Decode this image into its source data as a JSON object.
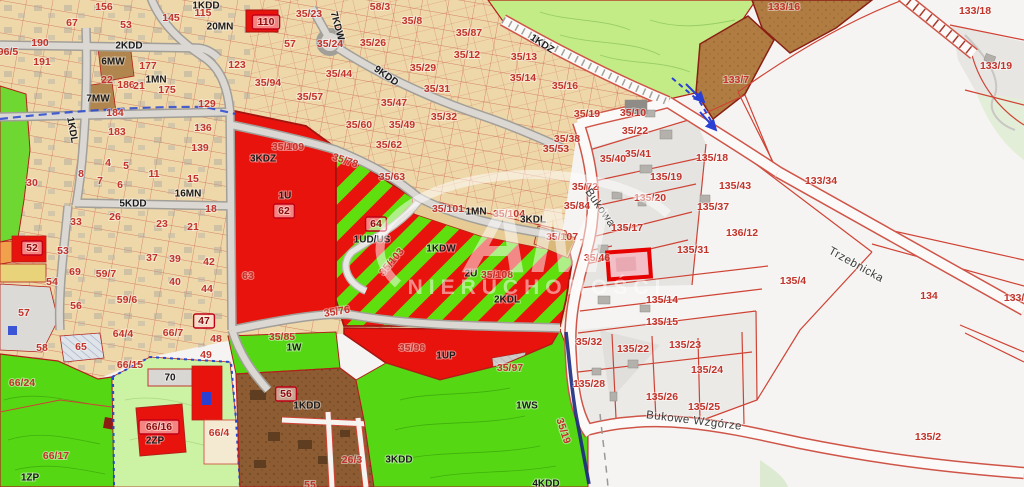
{
  "map": {
    "watermark": {
      "brand": "AM",
      "subtitle": "NIERUCHOMOŚCI"
    },
    "colors": {
      "urban_tan": "#eed8a9",
      "forest_green": "#c3ec86",
      "bright_green": "#55d714",
      "park_green": "#ccf2a4",
      "zone_red": "#e8130c",
      "stripe_green": "#5fdf0e",
      "brown_mw": "#b17c41",
      "brown_w": "#8d5c33",
      "gray_parcels": "#e5e4e1",
      "road_white": "#fbfaf8",
      "parcel_line_red": "#cf4335",
      "highlight_red": "#e60000",
      "stream_navy": "#1b2a7e",
      "utility_blue": "#2848d0"
    },
    "labels": [
      {
        "t": "156",
        "x": 104,
        "y": 7
      },
      {
        "t": "1KDD",
        "x": 206,
        "y": 6,
        "c": "d",
        "s": 8
      },
      {
        "t": "115",
        "x": 203,
        "y": 13
      },
      {
        "t": "67",
        "x": 72,
        "y": 23
      },
      {
        "t": "53",
        "x": 126,
        "y": 25
      },
      {
        "t": "145",
        "x": 171,
        "y": 18
      },
      {
        "t": "20MN",
        "x": 220,
        "y": 27,
        "c": "d",
        "s": 9
      },
      {
        "t": "190",
        "x": 40,
        "y": 43
      },
      {
        "t": "96/5",
        "x": 8,
        "y": 52
      },
      {
        "t": "2KDD",
        "x": 129,
        "y": 46,
        "c": "d",
        "s": 8
      },
      {
        "t": "191",
        "x": 42,
        "y": 62
      },
      {
        "t": "6MW",
        "x": 113,
        "y": 62,
        "c": "d",
        "s": 9
      },
      {
        "t": "177",
        "x": 148,
        "y": 66
      },
      {
        "t": "123",
        "x": 237,
        "y": 65
      },
      {
        "t": "1MN",
        "x": 156,
        "y": 80,
        "c": "d",
        "s": 9
      },
      {
        "t": "22",
        "x": 107,
        "y": 80
      },
      {
        "t": "186",
        "x": 126,
        "y": 85
      },
      {
        "t": "21",
        "x": 139,
        "y": 86
      },
      {
        "t": "175",
        "x": 167,
        "y": 90
      },
      {
        "t": "7MW",
        "x": 98,
        "y": 99,
        "c": "d",
        "s": 9
      },
      {
        "t": "129",
        "x": 207,
        "y": 104
      },
      {
        "t": "184",
        "x": 115,
        "y": 113
      },
      {
        "t": "183",
        "x": 117,
        "y": 132
      },
      {
        "t": "136",
        "x": 203,
        "y": 128
      },
      {
        "t": "139",
        "x": 200,
        "y": 148
      },
      {
        "t": "1KDL",
        "x": 72,
        "y": 130,
        "c": "d",
        "s": 8,
        "rot": 80
      },
      {
        "t": "30",
        "x": 32,
        "y": 183
      },
      {
        "t": "8",
        "x": 81,
        "y": 174
      },
      {
        "t": "7",
        "x": 100,
        "y": 181
      },
      {
        "t": "6",
        "x": 120,
        "y": 185
      },
      {
        "t": "4",
        "x": 108,
        "y": 163
      },
      {
        "t": "5",
        "x": 126,
        "y": 166
      },
      {
        "t": "11",
        "x": 154,
        "y": 174
      },
      {
        "t": "15",
        "x": 193,
        "y": 179
      },
      {
        "t": "16MN",
        "x": 188,
        "y": 194,
        "c": "d",
        "s": 9
      },
      {
        "t": "18",
        "x": 211,
        "y": 209
      },
      {
        "t": "33",
        "x": 76,
        "y": 222
      },
      {
        "t": "26",
        "x": 115,
        "y": 217
      },
      {
        "t": "5KDD",
        "x": 133,
        "y": 204,
        "c": "d",
        "s": 8
      },
      {
        "t": "23",
        "x": 162,
        "y": 224
      },
      {
        "t": "21",
        "x": 193,
        "y": 227
      },
      {
        "t": "52",
        "x": 32,
        "y": 248,
        "c": "b"
      },
      {
        "t": "53",
        "x": 63,
        "y": 251
      },
      {
        "t": "69",
        "x": 75,
        "y": 272
      },
      {
        "t": "59/7",
        "x": 106,
        "y": 274
      },
      {
        "t": "37",
        "x": 152,
        "y": 258
      },
      {
        "t": "39",
        "x": 175,
        "y": 259
      },
      {
        "t": "42",
        "x": 209,
        "y": 262
      },
      {
        "t": "40",
        "x": 175,
        "y": 282
      },
      {
        "t": "44",
        "x": 207,
        "y": 289
      },
      {
        "t": "54",
        "x": 52,
        "y": 282
      },
      {
        "t": "56",
        "x": 76,
        "y": 306
      },
      {
        "t": "59/6",
        "x": 127,
        "y": 300
      },
      {
        "t": "47",
        "x": 204,
        "y": 321,
        "c": "b"
      },
      {
        "t": "57",
        "x": 24,
        "y": 313
      },
      {
        "t": "35/23",
        "x": 309,
        "y": 14
      },
      {
        "t": "110",
        "x": 266,
        "y": 22,
        "c": "b"
      },
      {
        "t": "57",
        "x": 290,
        "y": 44
      },
      {
        "t": "35/24",
        "x": 330,
        "y": 44
      },
      {
        "t": "7KDW",
        "x": 337,
        "y": 26,
        "c": "d",
        "s": 8,
        "rot": 75
      },
      {
        "t": "58/3",
        "x": 380,
        "y": 7
      },
      {
        "t": "35/8",
        "x": 412,
        "y": 21
      },
      {
        "t": "35/87",
        "x": 469,
        "y": 33
      },
      {
        "t": "35/26",
        "x": 373,
        "y": 43
      },
      {
        "t": "35/12",
        "x": 467,
        "y": 55
      },
      {
        "t": "35/29",
        "x": 423,
        "y": 68
      },
      {
        "t": "9KDD",
        "x": 386,
        "y": 76,
        "c": "d",
        "s": 8,
        "rot": 35
      },
      {
        "t": "35/44",
        "x": 339,
        "y": 74
      },
      {
        "t": "35/94",
        "x": 268,
        "y": 83
      },
      {
        "t": "35/31",
        "x": 437,
        "y": 89
      },
      {
        "t": "35/57",
        "x": 310,
        "y": 97
      },
      {
        "t": "35/47",
        "x": 394,
        "y": 103
      },
      {
        "t": "35/32",
        "x": 444,
        "y": 117
      },
      {
        "t": "35/60",
        "x": 359,
        "y": 125
      },
      {
        "t": "35/49",
        "x": 402,
        "y": 125
      },
      {
        "t": "35/62",
        "x": 389,
        "y": 145
      },
      {
        "t": "35/63",
        "x": 392,
        "y": 177
      },
      {
        "t": "35/13",
        "x": 524,
        "y": 57
      },
      {
        "t": "35/14",
        "x": 523,
        "y": 78
      },
      {
        "t": "35/16",
        "x": 565,
        "y": 86
      },
      {
        "t": "1KDZ",
        "x": 542,
        "y": 44,
        "c": "d",
        "s": 8,
        "rot": 33
      },
      {
        "t": "35/19",
        "x": 587,
        "y": 114
      },
      {
        "t": "35/10",
        "x": 633,
        "y": 113
      },
      {
        "t": "35/22",
        "x": 635,
        "y": 131
      },
      {
        "t": "35/38",
        "x": 567,
        "y": 139
      },
      {
        "t": "35/53",
        "x": 556,
        "y": 149
      },
      {
        "t": "35/41",
        "x": 638,
        "y": 154
      },
      {
        "t": "35/40",
        "x": 613,
        "y": 159
      },
      {
        "t": "35/72",
        "x": 585,
        "y": 187
      },
      {
        "t": "35/84",
        "x": 577,
        "y": 206
      },
      {
        "t": "133/7",
        "x": 736,
        "y": 80
      },
      {
        "t": "133/16",
        "x": 784,
        "y": 7
      },
      {
        "t": "35/109",
        "x": 288,
        "y": 147
      },
      {
        "t": "3KDZ",
        "x": 263,
        "y": 159,
        "c": "d",
        "s": 9
      },
      {
        "t": "1U",
        "x": 285,
        "y": 196,
        "c": "d",
        "s": 13
      },
      {
        "t": "62",
        "x": 284,
        "y": 211,
        "c": "b"
      },
      {
        "t": "35/78",
        "x": 345,
        "y": 161,
        "rot": 18
      },
      {
        "t": "63",
        "x": 248,
        "y": 276,
        "s": 13
      },
      {
        "t": "64",
        "x": 376,
        "y": 224,
        "c": "b"
      },
      {
        "t": "1UD/US",
        "x": 372,
        "y": 240,
        "c": "d",
        "s": 12
      },
      {
        "t": "35/101",
        "x": 448,
        "y": 209
      },
      {
        "t": "1MN",
        "x": 476,
        "y": 212,
        "c": "d",
        "s": 9
      },
      {
        "t": "35/104",
        "x": 509,
        "y": 214
      },
      {
        "t": "3KDL",
        "x": 533,
        "y": 220,
        "c": "d",
        "s": 8
      },
      {
        "t": "35/107",
        "x": 562,
        "y": 237
      },
      {
        "t": "1KDW",
        "x": 441,
        "y": 249,
        "c": "d",
        "s": 9
      },
      {
        "t": "35/103",
        "x": 392,
        "y": 262,
        "rot": -50
      },
      {
        "t": "2U",
        "x": 471,
        "y": 274,
        "c": "d",
        "s": 11
      },
      {
        "t": "35/108",
        "x": 497,
        "y": 275
      },
      {
        "t": "2KDL",
        "x": 507,
        "y": 300,
        "c": "d",
        "s": 9
      },
      {
        "t": "35/76",
        "x": 337,
        "y": 312,
        "rot": -10
      },
      {
        "t": "Bukowa",
        "x": 600,
        "y": 208,
        "c": "n",
        "rot": 55
      },
      {
        "t": "Trzebnicka",
        "x": 856,
        "y": 265,
        "c": "n",
        "rot": 29
      },
      {
        "t": "Bukowe Wzgórze",
        "x": 694,
        "y": 421,
        "c": "n",
        "rot": 7
      },
      {
        "t": "133/34",
        "x": 821,
        "y": 181
      },
      {
        "t": "135/4",
        "x": 793,
        "y": 281
      },
      {
        "t": "134",
        "x": 929,
        "y": 296
      },
      {
        "t": "133/3",
        "x": 1017,
        "y": 298
      },
      {
        "t": "133/18",
        "x": 975,
        "y": 11
      },
      {
        "t": "133/19",
        "x": 996,
        "y": 66
      },
      {
        "t": "135/2",
        "x": 928,
        "y": 437
      },
      {
        "t": "135/19",
        "x": 666,
        "y": 177
      },
      {
        "t": "135/20",
        "x": 650,
        "y": 198
      },
      {
        "t": "135/17",
        "x": 627,
        "y": 228
      },
      {
        "t": "135/18",
        "x": 712,
        "y": 158
      },
      {
        "t": "135/43",
        "x": 735,
        "y": 186
      },
      {
        "t": "135/37",
        "x": 713,
        "y": 207
      },
      {
        "t": "136/12",
        "x": 742,
        "y": 233
      },
      {
        "t": "135/31",
        "x": 693,
        "y": 250
      },
      {
        "t": "35/46",
        "x": 597,
        "y": 258
      },
      {
        "t": "135/14",
        "x": 662,
        "y": 300
      },
      {
        "t": "135/15",
        "x": 662,
        "y": 322
      },
      {
        "t": "35/32",
        "x": 589,
        "y": 342
      },
      {
        "t": "135/22",
        "x": 633,
        "y": 349
      },
      {
        "t": "135/23",
        "x": 685,
        "y": 345
      },
      {
        "t": "135/24",
        "x": 707,
        "y": 370
      },
      {
        "t": "135/28",
        "x": 589,
        "y": 384
      },
      {
        "t": "135/26",
        "x": 662,
        "y": 397
      },
      {
        "t": "135/25",
        "x": 704,
        "y": 407
      },
      {
        "t": "35/19",
        "x": 563,
        "y": 431,
        "rot": 72
      },
      {
        "t": "35/85",
        "x": 282,
        "y": 337
      },
      {
        "t": "1W",
        "x": 294,
        "y": 348,
        "c": "d",
        "s": 10
      },
      {
        "t": "35/96",
        "x": 412,
        "y": 348
      },
      {
        "t": "1UP",
        "x": 446,
        "y": 356,
        "c": "d",
        "s": 13
      },
      {
        "t": "35/97",
        "x": 510,
        "y": 368
      },
      {
        "t": "1WS",
        "x": 527,
        "y": 406,
        "c": "d",
        "s": 13
      },
      {
        "t": "3KDD",
        "x": 399,
        "y": 460,
        "c": "d",
        "s": 10
      },
      {
        "t": "26/3",
        "x": 352,
        "y": 460
      },
      {
        "t": "4KDD",
        "x": 546,
        "y": 484,
        "c": "d",
        "s": 10
      },
      {
        "t": "56",
        "x": 286,
        "y": 394,
        "c": "b"
      },
      {
        "t": "1KDD",
        "x": 307,
        "y": 406,
        "c": "d",
        "s": 10
      },
      {
        "t": "55",
        "x": 310,
        "y": 485
      },
      {
        "t": "58",
        "x": 42,
        "y": 348
      },
      {
        "t": "65",
        "x": 81,
        "y": 347
      },
      {
        "t": "64/4",
        "x": 123,
        "y": 334
      },
      {
        "t": "66/7",
        "x": 173,
        "y": 333
      },
      {
        "t": "48",
        "x": 216,
        "y": 339
      },
      {
        "t": "49",
        "x": 206,
        "y": 355
      },
      {
        "t": "66/15",
        "x": 130,
        "y": 365
      },
      {
        "t": "66/24",
        "x": 22,
        "y": 383
      },
      {
        "t": "70",
        "x": 170,
        "y": 378,
        "c": "d",
        "s": 10
      },
      {
        "t": "66/16",
        "x": 159,
        "y": 427,
        "c": "b"
      },
      {
        "t": "2ZP",
        "x": 155,
        "y": 441,
        "c": "d",
        "s": 9
      },
      {
        "t": "66/4",
        "x": 219,
        "y": 433
      },
      {
        "t": "66/17",
        "x": 56,
        "y": 456
      },
      {
        "t": "1ZP",
        "x": 30,
        "y": 478,
        "c": "d",
        "s": 10
      }
    ]
  }
}
